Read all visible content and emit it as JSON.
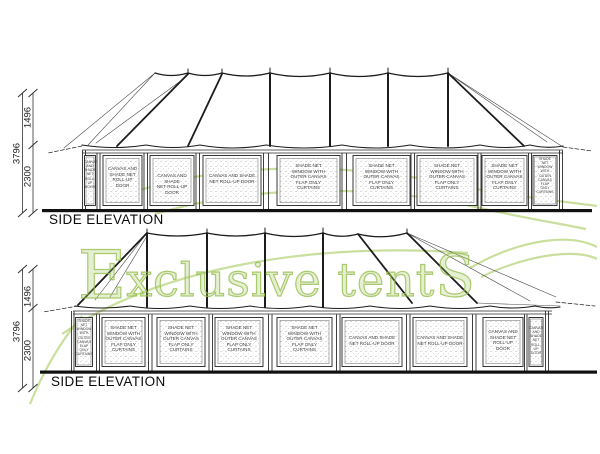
{
  "watermark": {
    "cap": "E",
    "body": "xclusive tent",
    "tail": "S",
    "color": "#c1da8e"
  },
  "colors": {
    "line": "#1c1c1c",
    "watermark_green": "#c1da8e",
    "panel_text": "#3f3f3f"
  },
  "elevations": [
    {
      "title": "SIDE ELEVATION",
      "dims": {
        "upper": "1496",
        "overall": "3796",
        "lower": "2300"
      },
      "panels": [
        {
          "label": "CANVAS\nAND\nSHADE\nNET\nROLL-UP\nDOOR"
        },
        {
          "label": "CANVAS AND\nSHADE NET\nROLL-UP\nDOOR"
        },
        {
          "label": "CANVAS AND SHADE\nNET ROLL-UP DOOR"
        },
        {
          "label": "CANVAS AND SHADE\nNET ROLL-UP DOOR"
        },
        {
          "label": "SHADE NET\nWINDOW WITH\nOUTER CANVAS\nFLAP ONLY\nCURTAINS"
        },
        {
          "label": "SHADE NET\nWINDOW WITH\nOUTER CANVAS\nFLAP ONLY\nCURTAINS"
        },
        {
          "label": "SHADE NET\nWINDOW WITH\nOUTER CANVAS\nFLAP ONLY\nCURTAINS"
        },
        {
          "label": "SHADE NET\nWINDOW WITH\nOUTER CANVAS\nFLAP ONLY\nCURTAINS"
        },
        {
          "label": "SHADE\nNET\nWINDOW\nWITH\nOUTER\nCANVAS\nFLAP\nONLY\nCURTAINS"
        }
      ]
    },
    {
      "title": "SIDE ELEVATION",
      "dims": {
        "upper": "1496",
        "overall": "3796",
        "lower": "2300"
      },
      "panels": [
        {
          "label": "SHADE\nNET\nWINDOW\nWITH\nOUTER\nCANVAS\nFLAP\nONLY\nCURTAINS"
        },
        {
          "label": "SHADE NET\nWINDOW WITH\nOUTER CANVAS\nFLAP ONLY\nCURTAINS"
        },
        {
          "label": "SHADE NET\nWINDOW WITH\nOUTER CANVAS\nFLAP ONLY\nCURTAINS"
        },
        {
          "label": "SHADE NET\nWINDOW WITH\nOUTER CANVAS\nFLAP ONLY\nCURTAINS"
        },
        {
          "label": "SHADE NET\nWINDOW WITH\nOUTER CANVAS\nFLAP ONLY\nCURTAINS"
        },
        {
          "label": "CANVAS AND SHADE\nNET ROLL-UP DOOR"
        },
        {
          "label": "CANVAS AND SHADE\nNET ROLL-UP DOOR"
        },
        {
          "label": "CANVAS AND\nSHADE NET\nROLL-UP\nDOOR"
        },
        {
          "label": "CANVAS\nAND\nSHADE\nNET\nROLL-UP\nDOOR"
        }
      ]
    }
  ]
}
